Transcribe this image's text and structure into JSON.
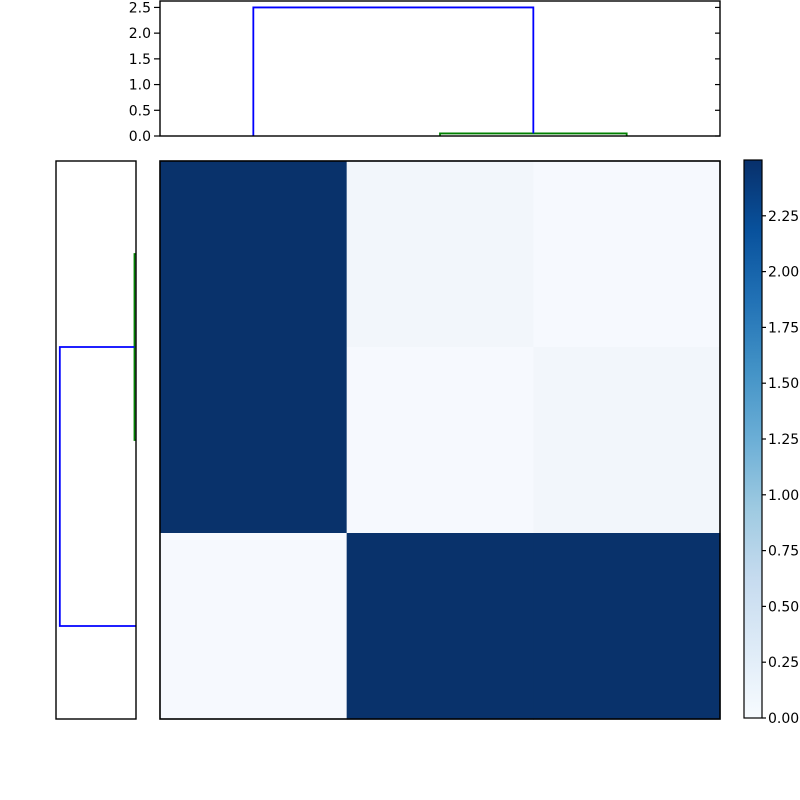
{
  "figure": {
    "background": "#ffffff",
    "description": "hierarchical clustering heatmap with row and column dendrograms and colorbar"
  },
  "chart_data": {
    "type": "heatmap",
    "subtype": "clustermap_with_dendrograms",
    "title": "",
    "xlabel": "",
    "ylabel": "",
    "grid": false,
    "legend": "none",
    "matrix": {
      "n_rows": 3,
      "n_cols": 3,
      "values": [
        [
          2.5,
          0.05,
          0.0
        ],
        [
          2.5,
          0.0,
          0.05
        ],
        [
          0.0,
          2.5,
          2.5
        ]
      ]
    },
    "cell_colors": [
      [
        "#09326b",
        "#f2f6fb",
        "#f6f9fe"
      ],
      [
        "#09326b",
        "#f6f9fe",
        "#f2f6fb"
      ],
      [
        "#f6f9fe",
        "#09326b",
        "#09326b"
      ]
    ],
    "vmin": 0.0,
    "vmax": 2.5,
    "colormap": {
      "name": "Blues",
      "stops_bottom_to_top": [
        "#f7fbff",
        "#deebf7",
        "#c6dbef",
        "#9ecae1",
        "#6baed6",
        "#4292c6",
        "#2171b5",
        "#08519c",
        "#08306b"
      ]
    },
    "axis_color": "#000000",
    "line_colors": {
      "dendrogram_blue": "#0000ff",
      "dendrogram_green": "#008000"
    },
    "top_dendrogram": {
      "orientation": "top",
      "n_leaves": 3,
      "axis_max": 2.625,
      "tick_values": [
        0.0,
        0.5,
        1.0,
        1.5,
        2.0,
        2.5
      ],
      "tick_labels": [
        "0.0",
        "0.5",
        "1.0",
        "1.5",
        "2.0",
        "2.5"
      ],
      "links": [
        {
          "color": "#008000",
          "a": {
            "leaf": 1,
            "base": 0
          },
          "b": {
            "leaf": 2,
            "base": 0
          },
          "height": 0.05
        },
        {
          "color": "#0000ff",
          "a": {
            "leaf": 0,
            "base": 0
          },
          "b": {
            "mid": [
              1,
              2
            ],
            "base": 0.05
          },
          "height": 2.5
        }
      ]
    },
    "left_dendrogram": {
      "orientation": "left",
      "n_leaves": 3,
      "axis_max": 2.625,
      "tick_values": [],
      "tick_labels": [],
      "links": [
        {
          "color": "#008000",
          "a": {
            "leaf": 0,
            "base": 0
          },
          "b": {
            "leaf": 1,
            "base": 0
          },
          "height": 0.05
        },
        {
          "color": "#0000ff",
          "a": {
            "mid": [
              0,
              1
            ],
            "base": 0.05
          },
          "b": {
            "leaf": 2,
            "base": 0
          },
          "height": 2.5
        }
      ]
    },
    "colorbar": {
      "tick_values": [
        0.0,
        0.25,
        0.5,
        0.75,
        1.0,
        1.25,
        1.5,
        1.75,
        2.0,
        2.25
      ],
      "tick_labels": [
        "0.00",
        "0.25",
        "0.50",
        "0.75",
        "1.00",
        "1.25",
        "1.50",
        "1.75",
        "2.00",
        "2.25"
      ]
    }
  }
}
